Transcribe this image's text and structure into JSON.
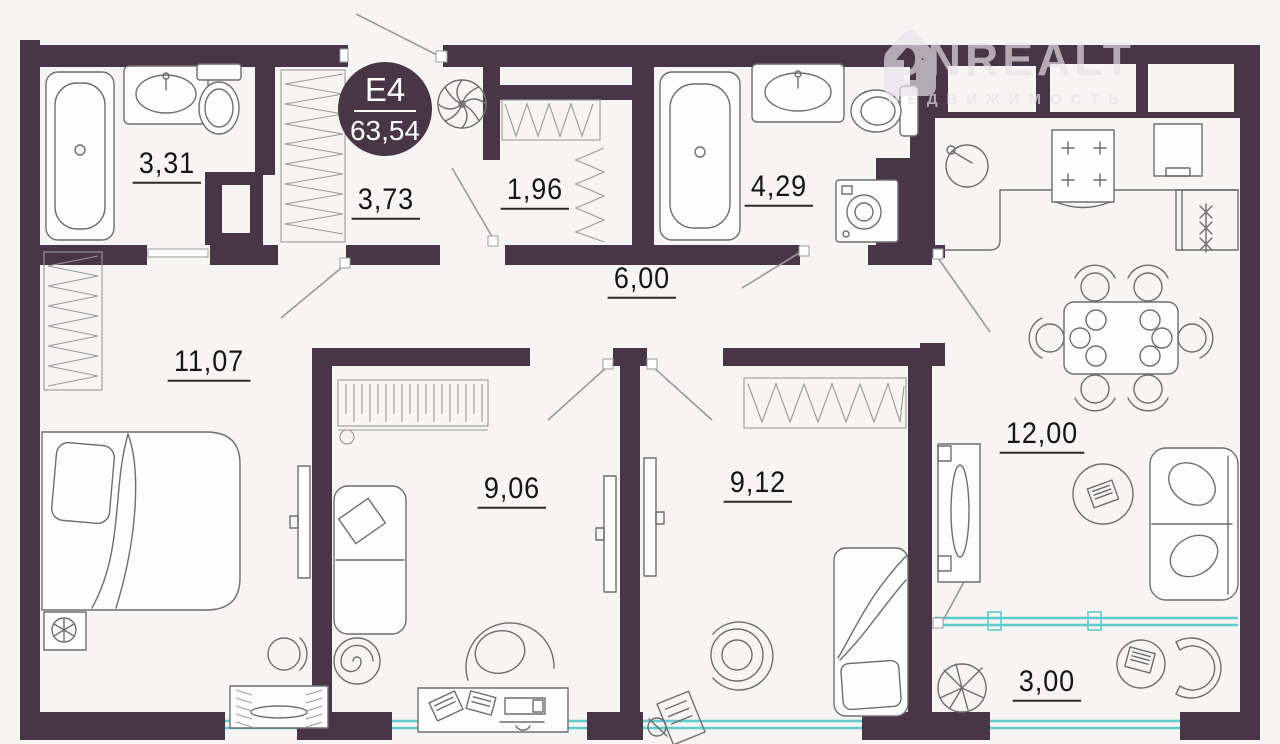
{
  "badge": {
    "unit": "Е4",
    "area": "63,54"
  },
  "logo": {
    "brand": "ONREALT",
    "tagline": "НЕДВИЖИМОСТЬ"
  },
  "rooms": [
    {
      "name": "bathroom-small",
      "area": "3,31"
    },
    {
      "name": "closet",
      "area": "3,73"
    },
    {
      "name": "storage",
      "area": "1,96"
    },
    {
      "name": "hallway",
      "area": "6,00"
    },
    {
      "name": "bathroom-large",
      "area": "4,29"
    },
    {
      "name": "bedroom",
      "area": "11,07"
    },
    {
      "name": "room-1",
      "area": "9,06"
    },
    {
      "name": "room-2",
      "area": "9,12"
    },
    {
      "name": "kitchen-living",
      "area": "12,00"
    },
    {
      "name": "balcony",
      "area": "3,00"
    }
  ],
  "colors": {
    "wall": "#483647",
    "background": "#f7f5f3",
    "window": "#5fcccb",
    "line": "#6e6e6e",
    "label": "#151515",
    "watermark": "#e8e2e8",
    "badge_text": "#ffffff"
  }
}
